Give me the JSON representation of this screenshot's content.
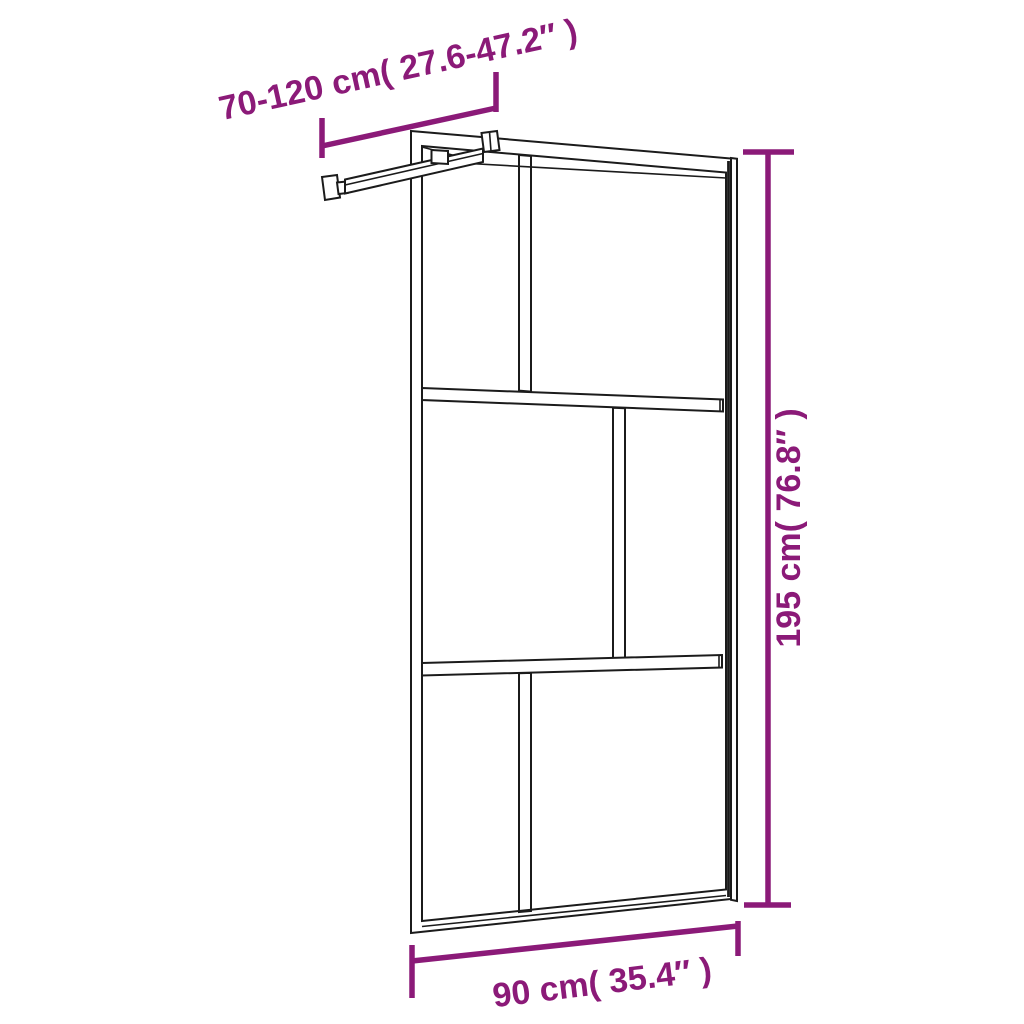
{
  "colors": {
    "dimension": "#8B1A78",
    "line": "#1B1B1B",
    "background": "#FFFFFF"
  },
  "labels": {
    "width_range": "70-120 cm( 27.6-47.2″ )",
    "height": "195 cm( 76.8″ )",
    "base_width": "90 cm( 35.4″ )"
  }
}
